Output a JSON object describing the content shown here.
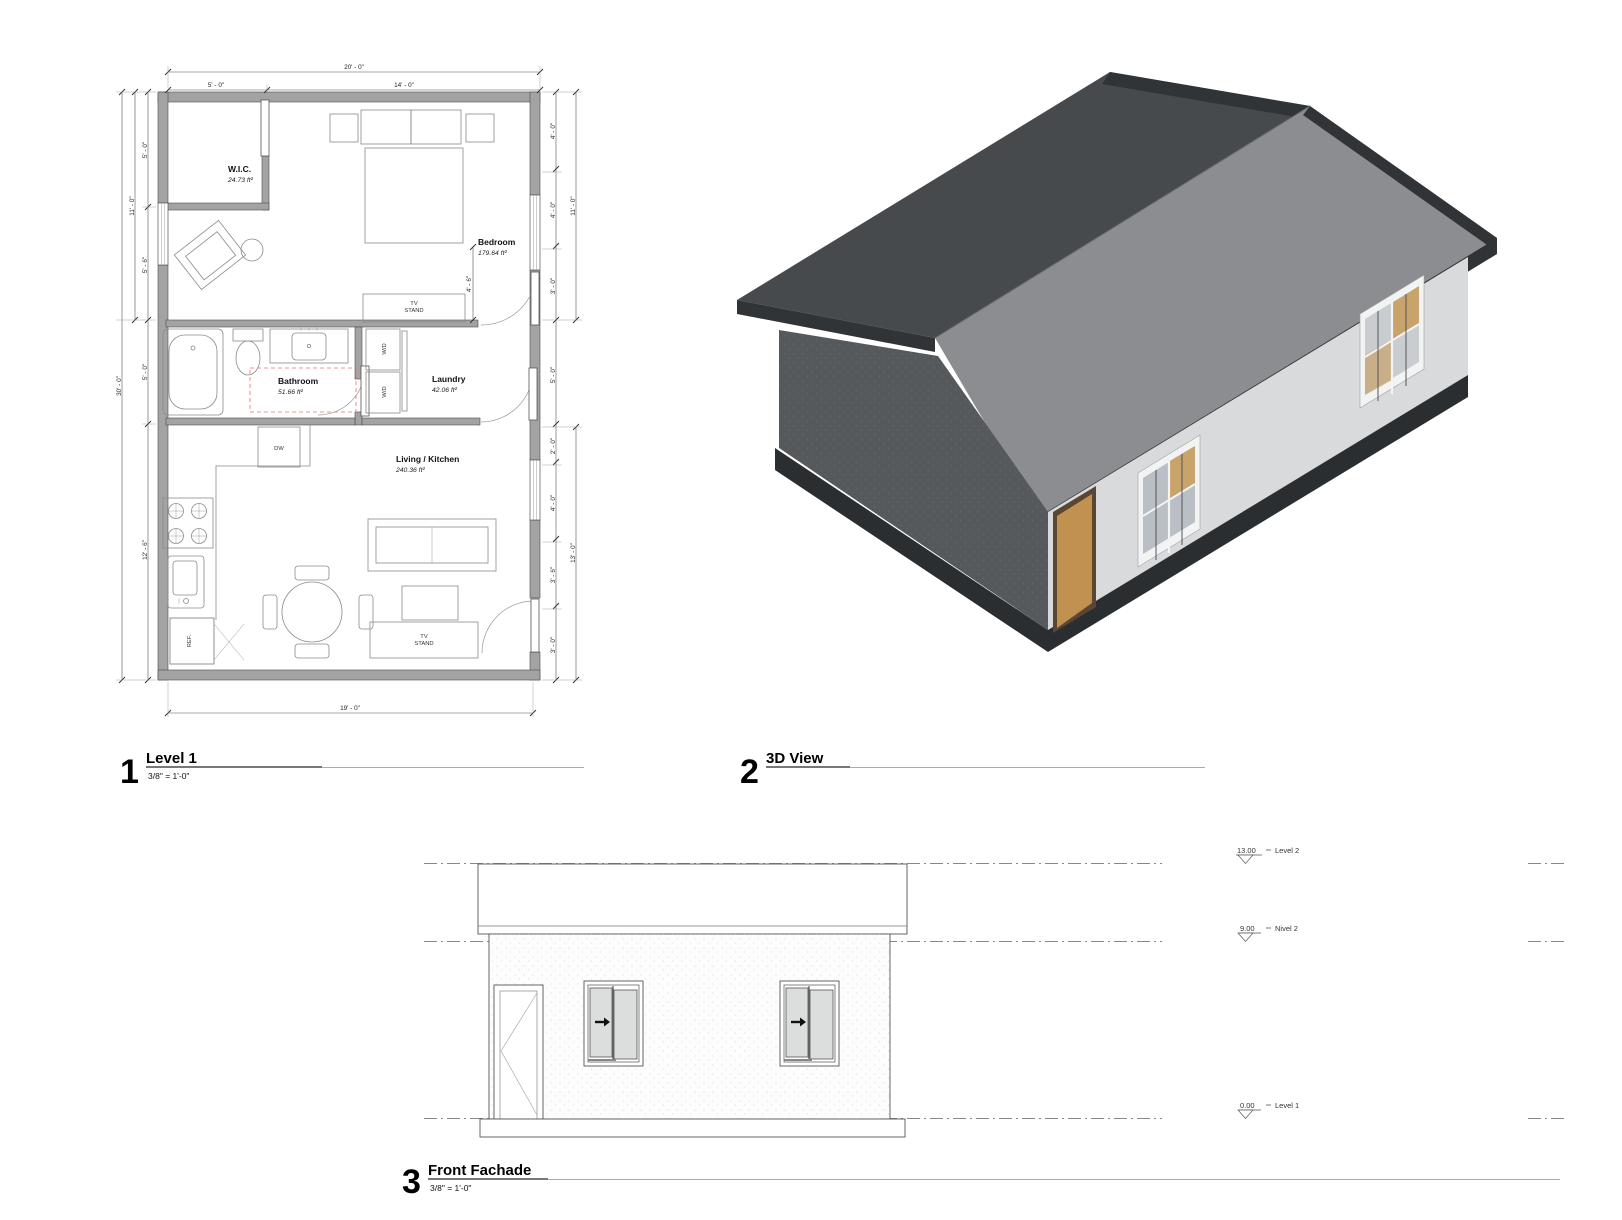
{
  "views": {
    "plan": {
      "number": "1",
      "title": "Level 1",
      "scale": "3/8\" = 1'-0\""
    },
    "three_d": {
      "number": "2",
      "title": "3D View"
    },
    "facade": {
      "number": "3",
      "title": "Front Fachade",
      "scale": "3/8\" = 1'-0\""
    }
  },
  "plan": {
    "rooms": {
      "wic": {
        "name": "W.I.C.",
        "area": "24.73 ft²"
      },
      "bedroom": {
        "name": "Bedroom",
        "area": "179.64 ft²"
      },
      "bathroom": {
        "name": "Bathroom",
        "area": "51.66 ft²"
      },
      "laundry": {
        "name": "Laundry",
        "area": "42.06 ft²"
      },
      "living": {
        "name": "Living / Kitchen",
        "area": "240.36 ft²"
      }
    },
    "fixtures": {
      "tv": "TV",
      "stand": "STAND",
      "wd": "W/D",
      "dw": "DW",
      "ref": "REF."
    },
    "dims": {
      "top_overall": "20' - 0\"",
      "top_left": "5' - 0\"",
      "top_right": "14' - 0\"",
      "bottom": "19' - 0\"",
      "left_overall": "30' - 0\"",
      "left_upper_overall": "11' - 0\"",
      "left_seg1": "5' - 0\"",
      "left_seg2": "5' - 6\"",
      "left_seg3": "5' - 0\"",
      "left_seg4": "12' - 6\"",
      "right_upper_overall": "11' - 0\"",
      "right_lower_overall": "13' - 0\"",
      "right_seg1": "4' - 0\"",
      "right_seg2": "4' - 0\"",
      "right_seg3": "3' - 0\"",
      "right_seg4": "5' - 0\"",
      "right_seg5": "2' - 0\"",
      "right_seg6": "4' - 0\"",
      "right_seg7": "3' - 6\"",
      "right_seg8": "3' - 0\"",
      "bedroom_interior": "4' - 6\""
    }
  },
  "elevation": {
    "levels": [
      {
        "value": "13.00",
        "name": "Level 2"
      },
      {
        "value": "9.00",
        "name": "Nivel 2"
      },
      {
        "value": "0.00",
        "name": "Level 1"
      }
    ]
  },
  "colors": {
    "roof_dark": "#474a4d",
    "roof_light": "#8b8d90",
    "trim_dark": "#313437",
    "gable_wall": "#56595c",
    "front_wall": "#d9dadb",
    "base_dark": "#2b2e30",
    "door_tan": "#c0914f",
    "plan_wall": "#a3a3a3",
    "red_dashed": "#e57373"
  }
}
